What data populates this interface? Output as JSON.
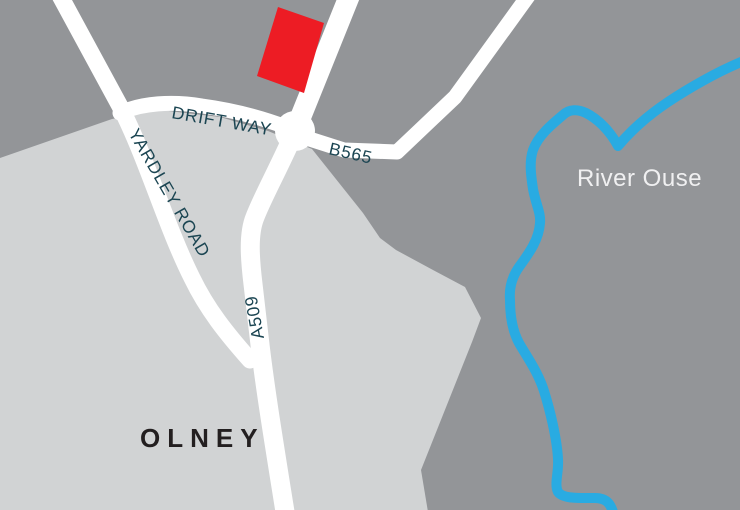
{
  "labels": {
    "road_drift_way": "DRIFT WAY",
    "road_b565": "B565",
    "road_yardley": "YARDLEY ROAD",
    "road_a509": "A509",
    "town_olney": "OLNEY",
    "river_ouse": "River Ouse"
  },
  "colors": {
    "background_land": "#939598",
    "town_area": "#D1D3D4",
    "road_fill": "#FFFFFF",
    "river_blue": "#29ABE2",
    "marker_red": "#ED1C24",
    "road_label_text": "#1B4552",
    "town_label_text": "#231F20",
    "river_label_text": "#F0F0F1"
  }
}
